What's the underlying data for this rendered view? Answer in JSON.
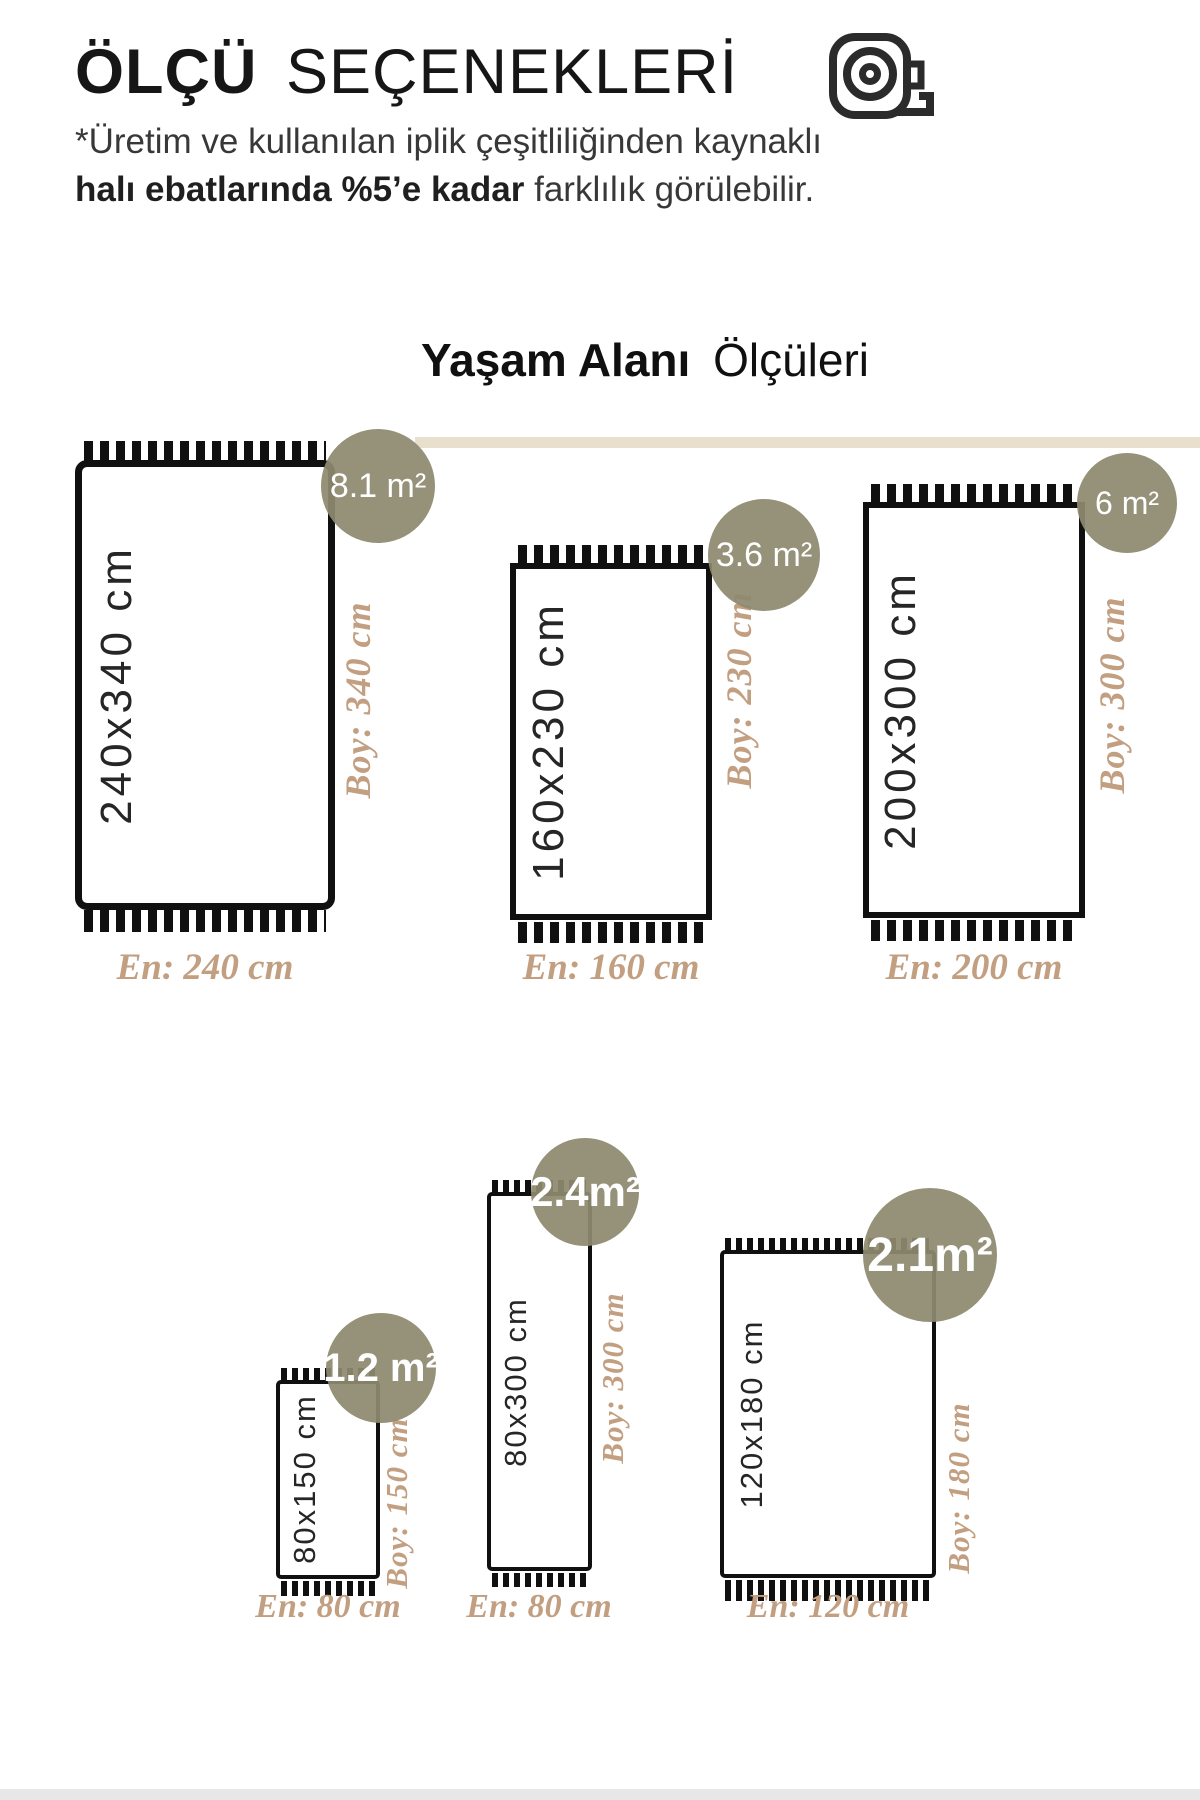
{
  "header": {
    "title_primary": "ÖLÇÜ",
    "title_secondary": "SEÇENEKLERİ",
    "note_line1": "*Üretim ve kullanılan iplik çeşitliliğinden kaynaklı",
    "note_bold": "halı ebatlarında %5’e kadar",
    "note_rest": " farklılık görülebilir.",
    "icon": "tape-measure-icon"
  },
  "section": {
    "heading_primary": "Yaşam Alanı",
    "heading_secondary": "Ölçüleri"
  },
  "colors": {
    "badge_olive": "#8e8a6f",
    "label_tan": "#c29f81",
    "band_beige": "#e9dfcd",
    "outline_black": "#101010"
  },
  "rugs": [
    {
      "id": "240x340",
      "size_label": "240x340 cm",
      "area_label": "8.1 m²",
      "boy_label": "Boy: 340 cm",
      "en_label": "En: 240 cm"
    },
    {
      "id": "160x230",
      "size_label": "160x230 cm",
      "area_label": "3.6 m²",
      "boy_label": "Boy: 230 cm",
      "en_label": "En: 160 cm"
    },
    {
      "id": "200x300",
      "size_label": "200x300 cm",
      "area_label": "6 m²",
      "boy_label": "Boy: 300 cm",
      "en_label": "En: 200 cm"
    },
    {
      "id": "80x150",
      "size_label": "80x150 cm",
      "area_label": "1.2 m²",
      "boy_label": "Boy: 150 cm",
      "en_label": "En: 80 cm"
    },
    {
      "id": "80x300",
      "size_label": "80x300 cm",
      "area_label": "2.4m²",
      "boy_label": "Boy: 300 cm",
      "en_label": "En: 80 cm"
    },
    {
      "id": "120x180",
      "size_label": "120x180 cm",
      "area_label": "2.1m²",
      "boy_label": "Boy: 180 cm",
      "en_label": "En: 120 cm"
    }
  ]
}
